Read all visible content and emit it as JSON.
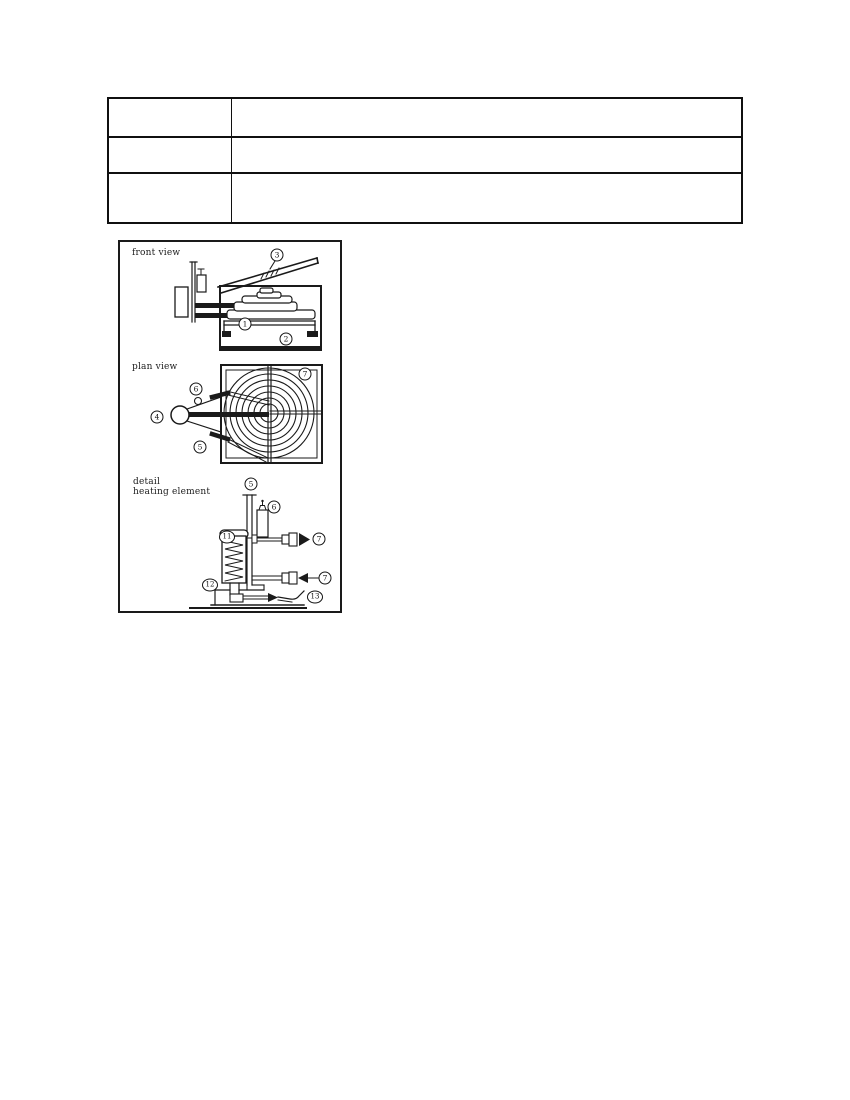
{
  "document": {
    "table": {
      "rows": [
        {
          "c1": "",
          "c2": ""
        },
        {
          "c1": "",
          "c2": ""
        },
        {
          "c1": "",
          "c2": ""
        }
      ]
    },
    "figure": {
      "front_view": {
        "label": "front view",
        "callouts": {
          "chute": "3",
          "plate": "1",
          "base": "2"
        }
      },
      "plan_view": {
        "label": "plan view",
        "callouts": {
          "square": "7",
          "upper_lead": "6",
          "knob": "4",
          "lower_lead": "5"
        }
      },
      "detail_view": {
        "label_line1": "detail",
        "label_line2": "heating element",
        "callouts": {
          "tube": "5",
          "cylinder": "6",
          "outlet": "7",
          "inlet": "7",
          "coil": "11",
          "base": "12",
          "nozzle": "13"
        }
      },
      "line_color": "#1a1a1a"
    }
  }
}
